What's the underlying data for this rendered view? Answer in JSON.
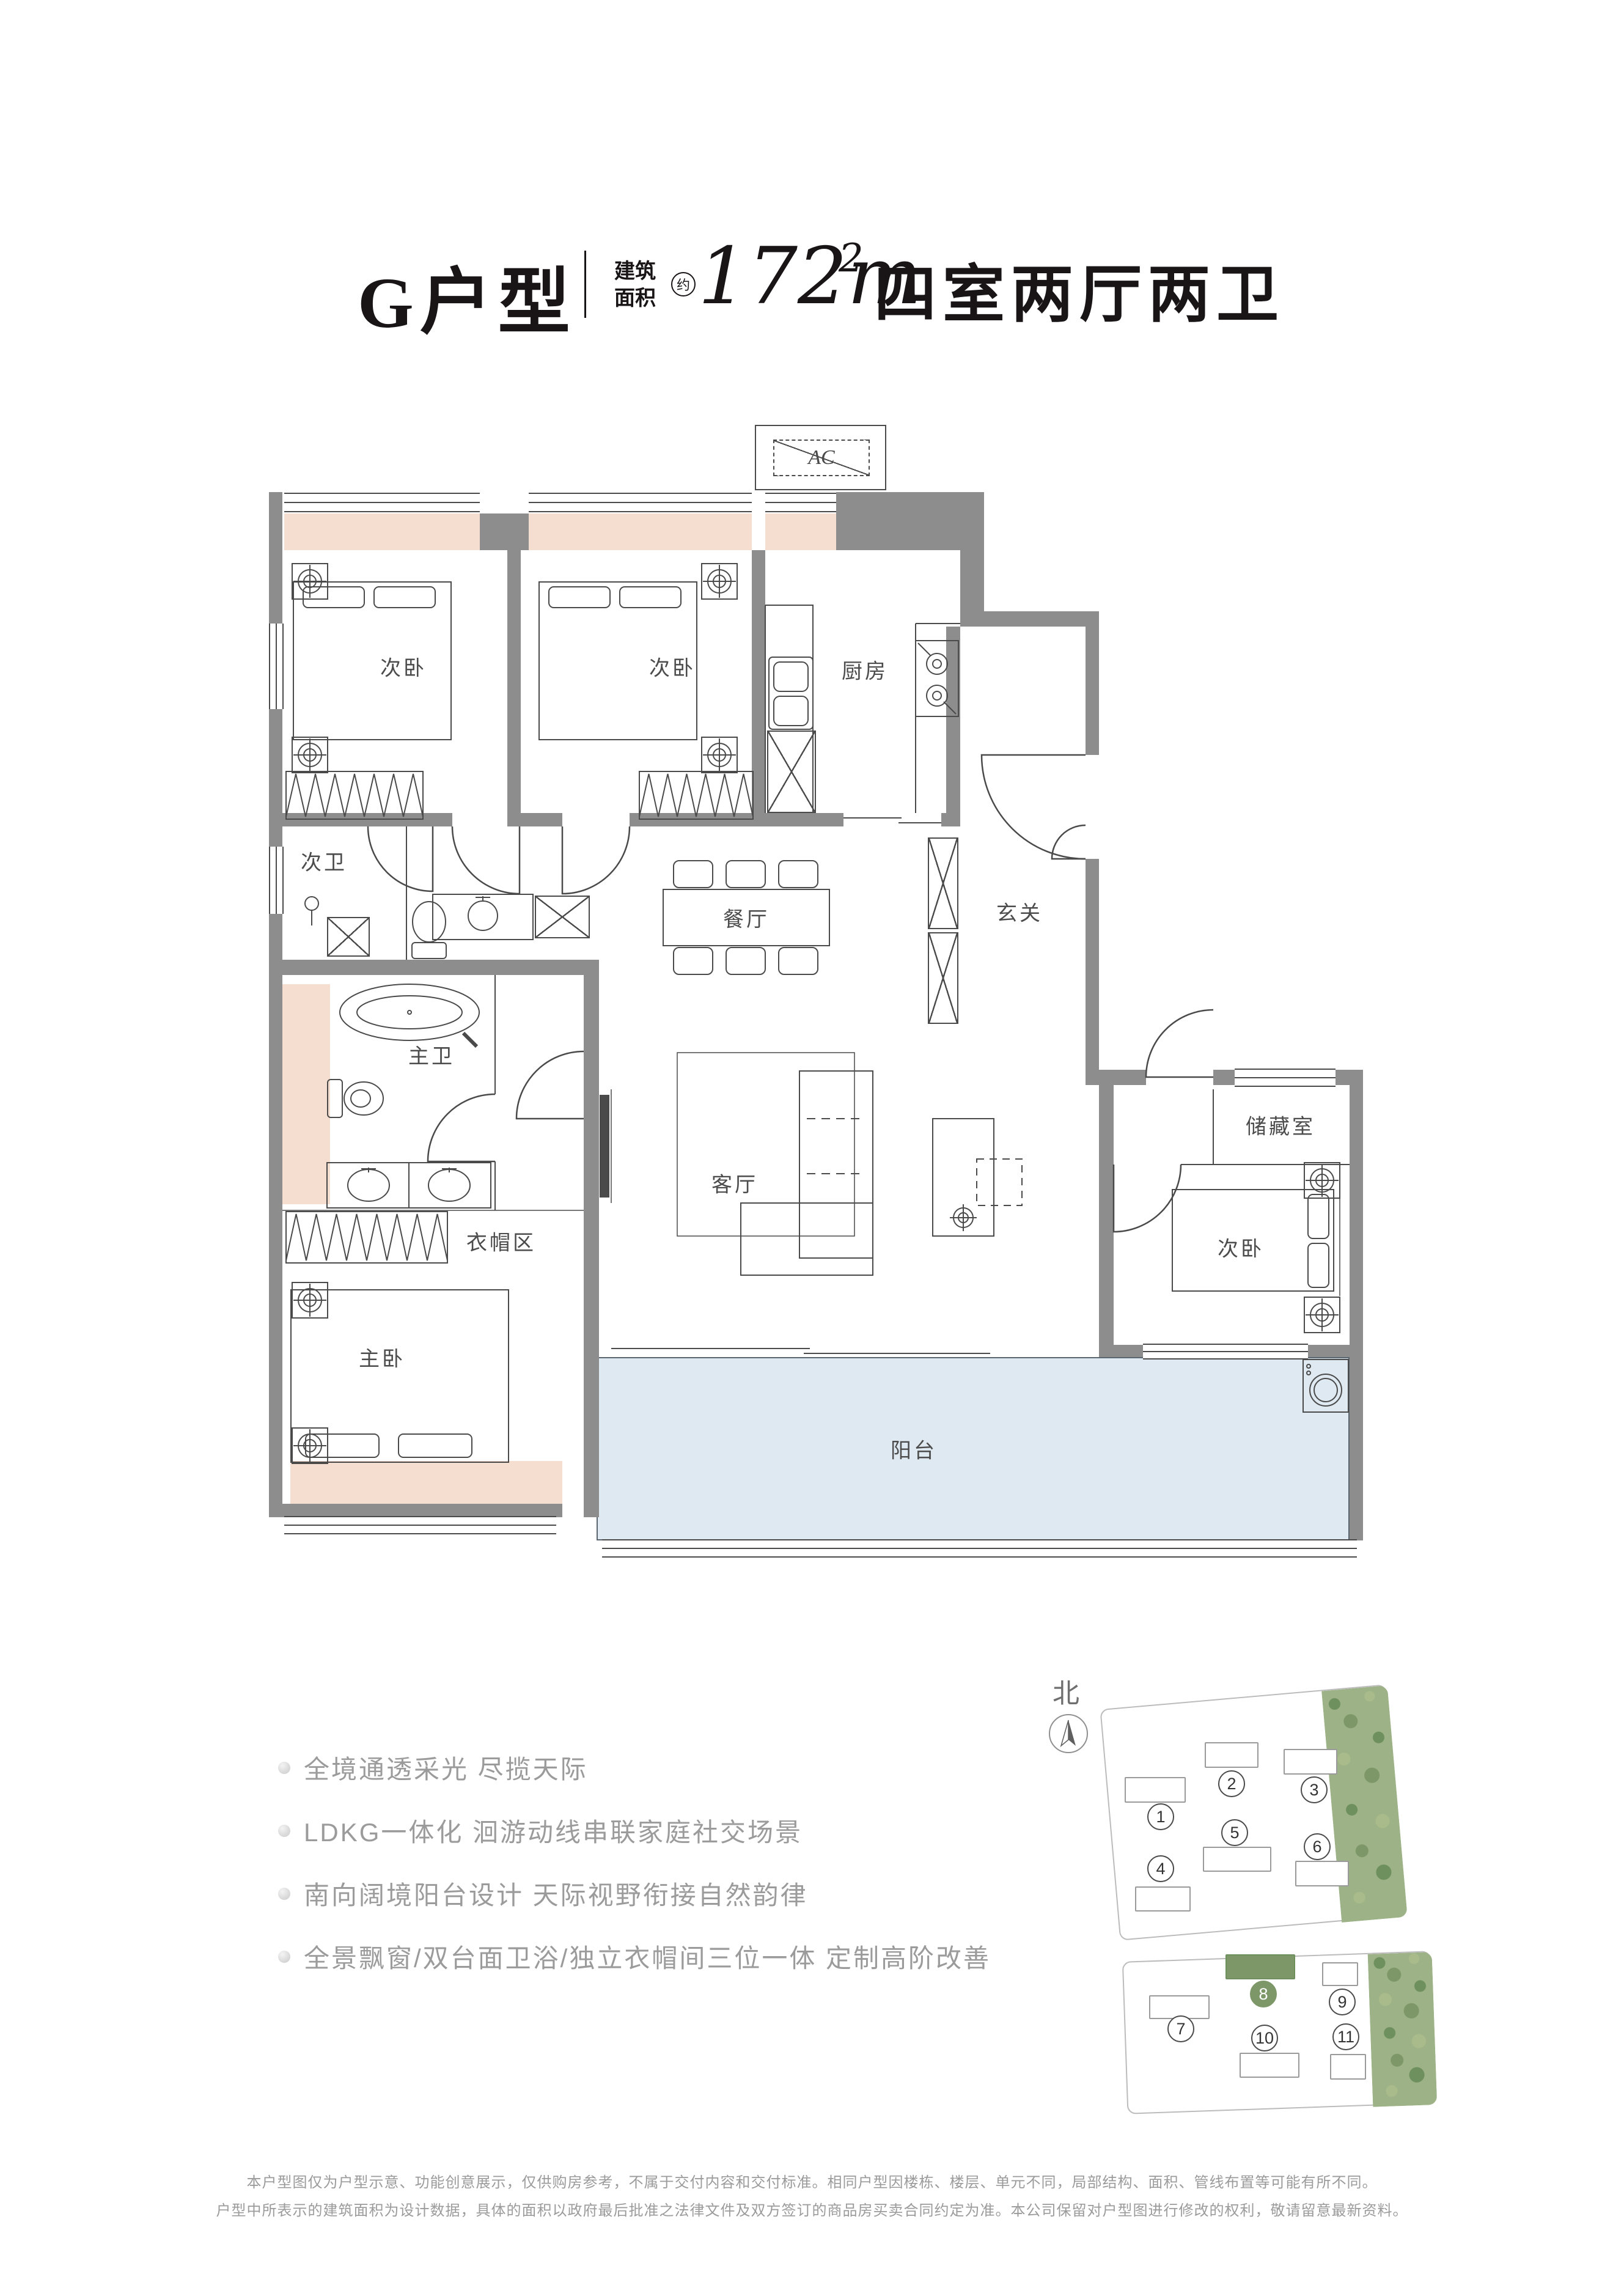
{
  "title": {
    "unit_name": "G户型",
    "area_label_top": "建筑",
    "area_label_bottom": "面积",
    "area_approx": "约",
    "area_number": "172",
    "area_exponent": "2",
    "rooms_summary": "四室两厅两卫"
  },
  "floor_plan": {
    "ac_label": "AC",
    "rooms": [
      {
        "id": "bedroom-2a",
        "label": "次卧"
      },
      {
        "id": "bedroom-2b",
        "label": "次卧"
      },
      {
        "id": "kitchen",
        "label": "厨房"
      },
      {
        "id": "bathroom-2",
        "label": "次卫"
      },
      {
        "id": "dining-room",
        "label": "餐厅"
      },
      {
        "id": "entry-hall",
        "label": "玄关"
      },
      {
        "id": "master-bathroom",
        "label": "主卫"
      },
      {
        "id": "cloakroom",
        "label": "衣帽区"
      },
      {
        "id": "master-bedroom",
        "label": "主卧"
      },
      {
        "id": "living-room",
        "label": "客厅"
      },
      {
        "id": "storage-room",
        "label": "储藏室"
      },
      {
        "id": "bedroom-2c",
        "label": "次卧"
      },
      {
        "id": "balcony",
        "label": "阳台"
      }
    ]
  },
  "features": {
    "items": [
      "全境通透采光 尽揽天际",
      "LDKG一体化 洄游动线串联家庭社交场景",
      "南向阔境阳台设计 天际视野衔接自然韵律",
      "全景飘窗/双台面卫浴/独立衣帽间三位一体 定制高阶改善"
    ]
  },
  "site_map": {
    "north_label": "北",
    "highlighted_building": "8",
    "buildings": [
      {
        "no": "1"
      },
      {
        "no": "2"
      },
      {
        "no": "3"
      },
      {
        "no": "4"
      },
      {
        "no": "5"
      },
      {
        "no": "6"
      },
      {
        "no": "7"
      },
      {
        "no": "8"
      },
      {
        "no": "9"
      },
      {
        "no": "10"
      },
      {
        "no": "11"
      }
    ]
  },
  "footer": {
    "line1": "本户型图仅为户型示意、功能创意展示，仅供购房参考，不属于交付内容和交付标准。相同户型因楼栋、楼层、单元不同，局部结构、面积、管线布置等可能有所不同。",
    "line2": "户型中所表示的建筑面积为设计数据，具体的面积以政府最后批准之法律文件及双方签订的商品房买卖合同约定为准。本公司保留对户型图进行修改的权利，敬请留意最新资料。"
  }
}
